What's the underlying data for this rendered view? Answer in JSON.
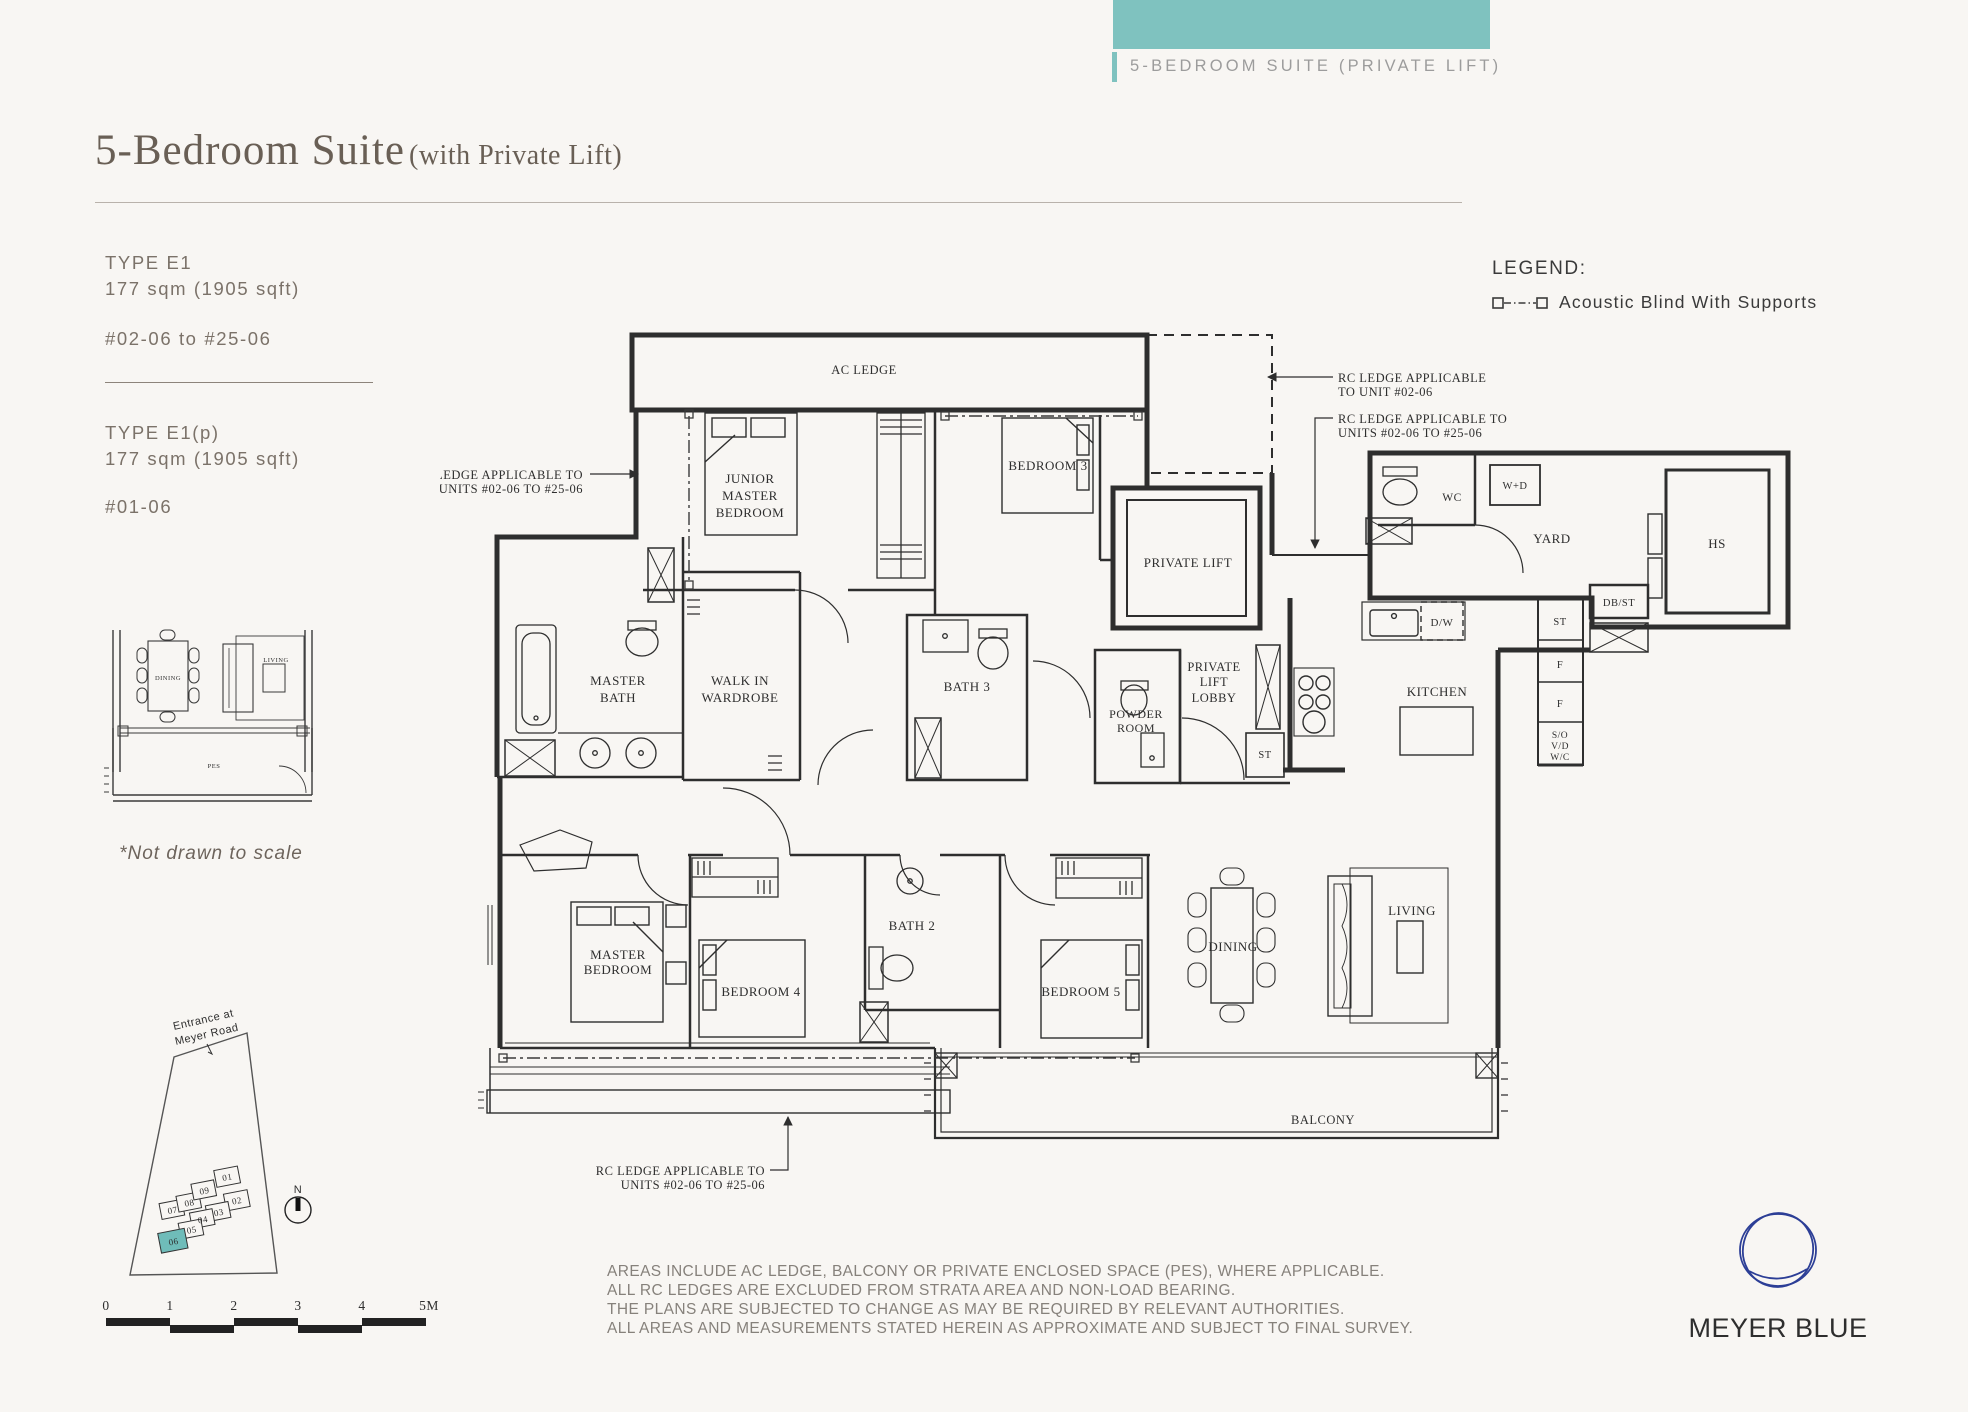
{
  "banner": {
    "label": "5-BEDROOM SUITE (PRIVATE LIFT)",
    "accent_teal": "#7fc2bf"
  },
  "header": {
    "title_main": "5-Bedroom Suite",
    "title_sub": "(with Private Lift)"
  },
  "types": [
    {
      "label": "TYPE E1",
      "area": "177 sqm (1905 sqft)",
      "units": "#02-06 to #25-06"
    },
    {
      "label": "TYPE E1(p)",
      "area": "177 sqm (1905 sqft)",
      "units": "#01-06"
    }
  ],
  "legend": {
    "heading": "LEGEND:",
    "item": "Acoustic Blind With Supports"
  },
  "mini": {
    "dining": "DINING",
    "living": "LIVING",
    "pes": "PES",
    "caption": "*Not drawn to scale"
  },
  "site": {
    "entrance_1": "Entrance at",
    "entrance_2": "Meyer Road",
    "north": "N",
    "units": [
      "01",
      "02",
      "03",
      "04",
      "05",
      "06",
      "07",
      "08",
      "09"
    ],
    "highlighted_unit": "06",
    "highlight_color": "#6fbcb9"
  },
  "scale": {
    "ticks": [
      "0",
      "1",
      "2",
      "3",
      "4",
      "5M"
    ]
  },
  "plan": {
    "rooms": {
      "ac_ledge": "AC LEDGE",
      "junior_1": "JUNIOR",
      "junior_2": "MASTER",
      "junior_3": "BEDROOM",
      "bedroom3": "BEDROOM 3",
      "private_lift": "PRIVATE LIFT",
      "wc": "WC",
      "wd": "W+D",
      "yard": "YARD",
      "hs": "HS",
      "dbst": "DB/ST",
      "st_col": "ST",
      "f1": "F",
      "f2": "F",
      "so": "S/O",
      "vd": "V/D",
      "wc2": "W/C",
      "dw": "D/W",
      "kitchen": "KITCHEN",
      "master_bath_1": "MASTER",
      "master_bath_2": "BATH",
      "wiw_1": "WALK IN",
      "wiw_2": "WARDROBE",
      "bath3": "BATH 3",
      "powder_1": "POWDER",
      "powder_2": "ROOM",
      "lobby_1": "PRIVATE",
      "lobby_2": "LIFT",
      "lobby_3": "LOBBY",
      "st_lobby": "ST",
      "mbr_1": "MASTER",
      "mbr_2": "BEDROOM",
      "bedroom4": "BEDROOM 4",
      "bath2": "BATH 2",
      "bedroom5": "BEDROOM 5",
      "dining": "DINING",
      "living": "LIVING",
      "balcony": "BALCONY"
    },
    "notes": {
      "left_1": "RC LEDGE APPLICABLE TO",
      "left_2": "UNITS #02-06 TO #25-06",
      "r1_1": "RC LEDGE APPLICABLE",
      "r1_2": "TO UNIT #02-06",
      "r2_1": "RC LEDGE APPLICABLE TO",
      "r2_2": "UNITS #02-06 TO #25-06",
      "b_1": "RC LEDGE APPLICABLE TO",
      "b_2": "UNITS #02-06 TO #25-06"
    }
  },
  "footer": {
    "lines": [
      "AREAS INCLUDE AC LEDGE, BALCONY OR PRIVATE ENCLOSED SPACE (PES), WHERE APPLICABLE.",
      "ALL RC LEDGES ARE EXCLUDED FROM STRATA AREA AND NON-LOAD BEARING.",
      "THE PLANS ARE SUBJECTED TO CHANGE AS MAY BE REQUIRED BY RELEVANT AUTHORITIES.",
      "ALL AREAS AND MEASUREMENTS STATED HEREIN AS APPROXIMATE AND SUBJECT TO FINAL SURVEY."
    ]
  },
  "brand": {
    "name": "MEYER BLUE",
    "navy": "#2c3e96"
  }
}
